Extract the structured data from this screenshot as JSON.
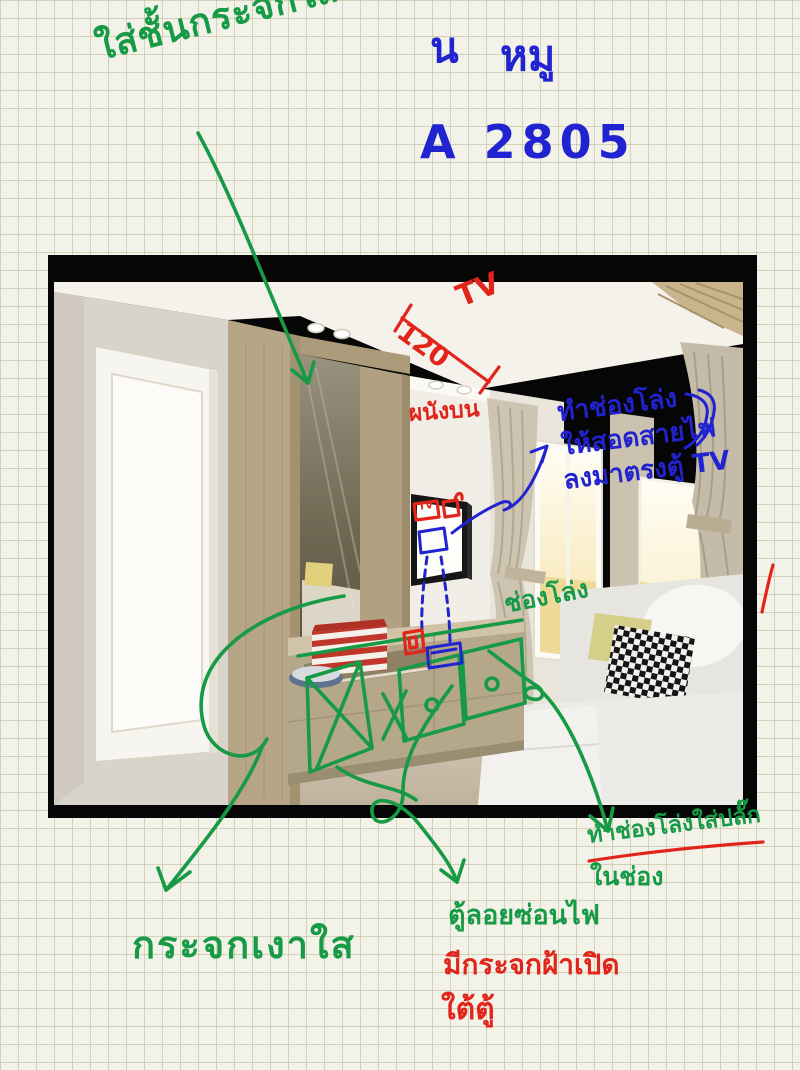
{
  "header": {
    "name_prefix": "น",
    "name": "หมู",
    "unit_code": "A 2805"
  },
  "notes": {
    "green": {
      "shelf_note": "ใส่ชั้นกระจกใส",
      "gap_note": "ช่องโล่ง",
      "plug_note_line1": "ทำช่องโล่งใส่ปลั๊ก",
      "plug_note_line2": "ในช่อง",
      "mirror_note": "กระจกเงาใส",
      "floating_cabinet_note": "ตู้ลอยซ่อนไฟ"
    },
    "blue": {
      "wire_note_line1": "ทำช่องโล่ง",
      "wire_note_line2": "ให้สอดสายไฟ",
      "wire_note_line3": "ลงมาตรงตู้ TV"
    },
    "red": {
      "tv_label": "TV",
      "tv_box_label": "TV",
      "dimension_value": "120",
      "wall_note": "ผนังบน",
      "frosted_glass_line1": "มีกระจกฝ้าเปิด",
      "frosted_glass_line2": "ใต้ตู้"
    }
  },
  "colors": {
    "marker_green": "#169a45",
    "marker_blue": "#2023cf",
    "marker_red": "#e2251b",
    "paper": "#f3f2e9",
    "grid_line": "#9294 60",
    "photo_frame": "#060606"
  }
}
